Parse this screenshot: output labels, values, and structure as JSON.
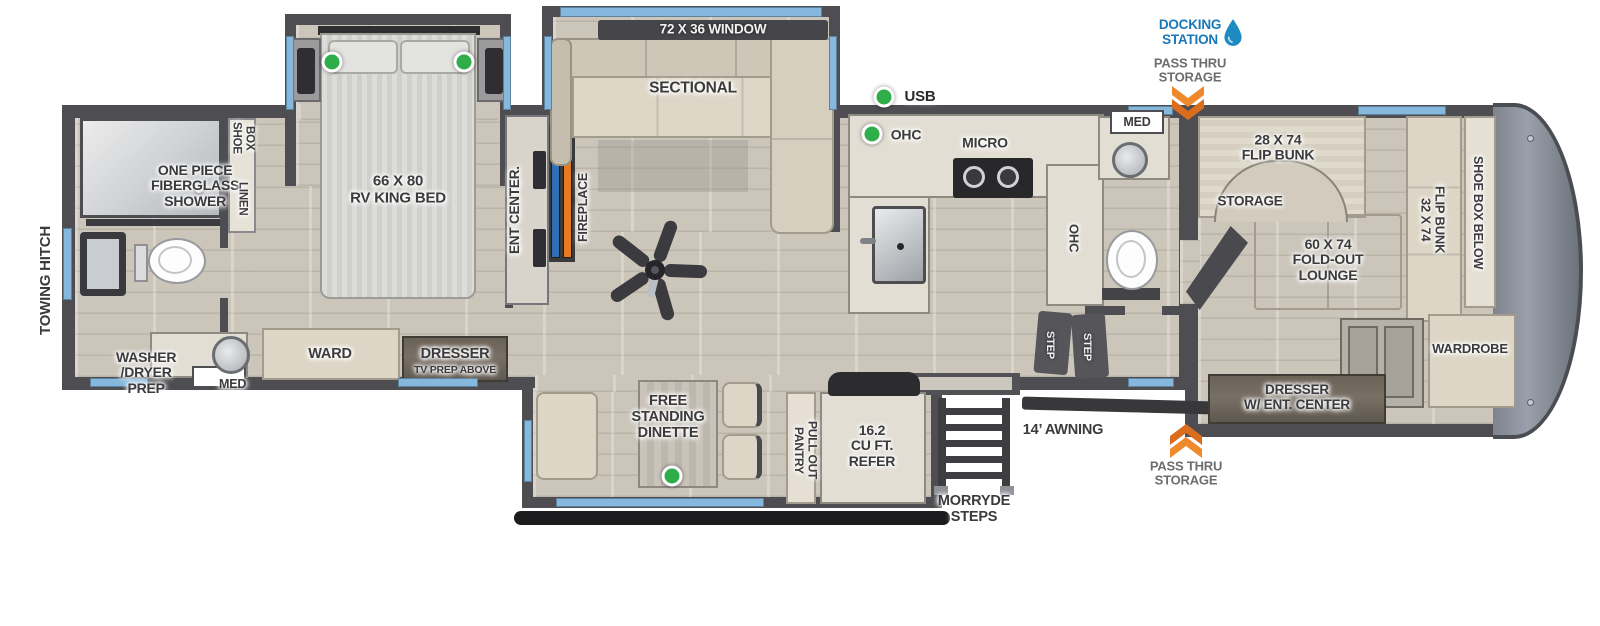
{
  "colors": {
    "wall": "#4e4e52",
    "window_blue": "#85b8dc",
    "accent_blue": "#1878b8",
    "accent_orange": "#e87a22",
    "indicator_green": "#2ead49",
    "floor": "#cbc5ba",
    "furniture": "#ddd6c6",
    "counter": "#e2ded4",
    "cap_gray": "#9aa0ab",
    "label_text": "#3b3b3d"
  },
  "labels": {
    "towing_hitch": "TOWING HITCH",
    "shower": "ONE PIECE\nFIBERGLASS\nSHOWER",
    "shoe_box": "SHOE\nBOX",
    "linen": "LINEN",
    "washer_dryer_prep": "WASHER\n/DRYER\nPREP",
    "med_rear": "MED",
    "king_bed": "66 X 80\nRV KING BED",
    "ward": "WARD",
    "dresser_rear_line1": "DRESSER",
    "dresser_rear_line2": "TV PREP ABOVE",
    "ent_center": "ENT CENTER.",
    "fireplace": "FIREPLACE",
    "window_72x36": "72 X 36 WINDOW",
    "sectional": "SECTIONAL",
    "usb": "USB",
    "ohc_upper": "OHC",
    "micro": "MICRO",
    "ohc_side": "OHC",
    "step_left": "STEP",
    "step_right": "STEP",
    "med_front": "MED",
    "flip_bunk_28": "28 X 74\nFLIP BUNK",
    "storage": "STORAGE",
    "fold_out_lounge": "60 X 74\nFOLD-OUT\nLOUNGE",
    "flip_bunk_32": "32 X 74\nFLIP BUNK",
    "shoe_box_below": "SHOE BOX BELOW",
    "wardrobe": "WARDROBE",
    "dresser_front": "DRESSER\nW/ ENT. CENTER",
    "free_standing_dinette": "FREE\nSTANDING\nDINETTE",
    "pull_out_pantry": "PULL OUT PANTRY",
    "refer": "16.2\nCU FT.\nREFER",
    "morryde_steps": "MORRYDE\nSTEPS",
    "awning": "14’ AWNING"
  },
  "annotations": {
    "docking_station": "DOCKING\nSTATION",
    "pass_thru_top": "PASS THRU\nSTORAGE",
    "pass_thru_bottom": "PASS THRU\nSTORAGE"
  }
}
